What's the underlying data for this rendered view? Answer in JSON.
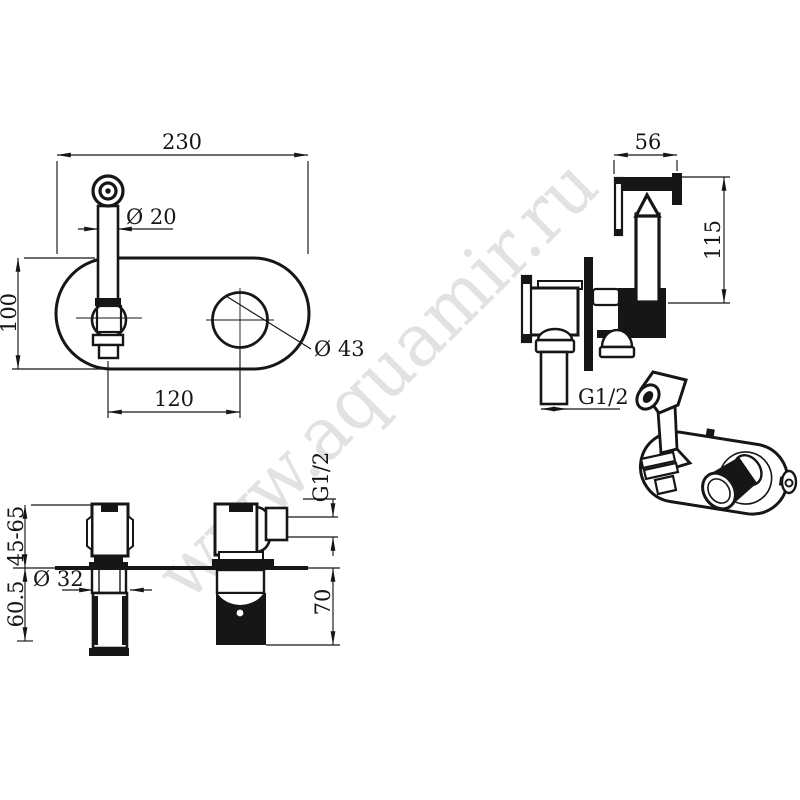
{
  "page": {
    "background": "#ffffff",
    "line_color": "#161616"
  },
  "watermark": {
    "text": "www.aquamir.ru",
    "color": "#e2e2e2"
  },
  "views": {
    "front": {
      "dim_width": "230",
      "dim_height": "100",
      "dim_spout_diameter": "Ø 20",
      "dim_knob_diameter": "Ø 43",
      "dim_centers": "120"
    },
    "side": {
      "dim_holder_width": "56",
      "dim_holder_height": "115",
      "dim_thread": "G1/2"
    },
    "top": {
      "dim_depth_range": "45-65",
      "dim_depth": "60.5",
      "dim_valve_diameter": "Ø 32",
      "dim_drop": "70",
      "dim_thread": "G1/2"
    }
  }
}
